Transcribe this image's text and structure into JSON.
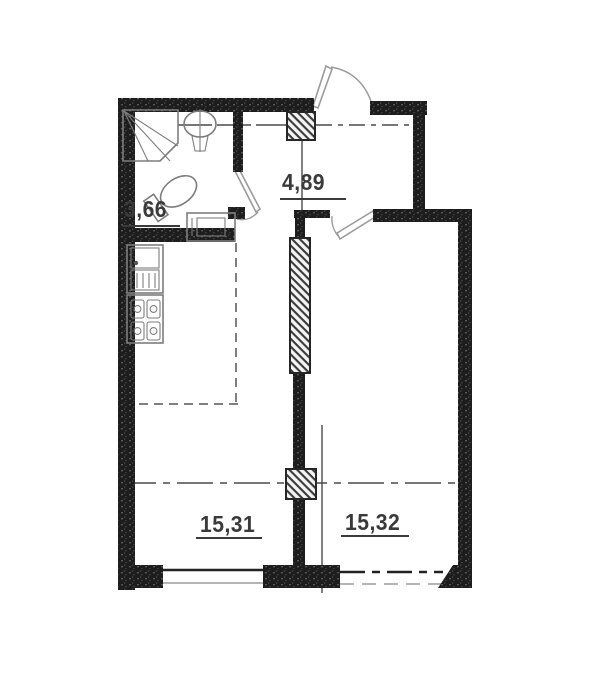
{
  "plan": {
    "title": "apartment-floor-plan",
    "rooms": {
      "bathroom": {
        "name": "bathroom",
        "area": "3,66"
      },
      "hallway": {
        "name": "hallway",
        "area": "4,89"
      },
      "living_kitchen": {
        "name": "kitchen-living-room",
        "area": "15,31"
      },
      "bedroom": {
        "name": "bedroom",
        "area": "15,32"
      }
    },
    "fixtures": [
      "shower",
      "washbasin",
      "toilet",
      "washing-machine",
      "kitchen-sink",
      "stove",
      "vent-shaft-top",
      "vent-shaft-bottom"
    ],
    "doors": [
      "entry-door",
      "bathroom-door",
      "bedroom-door"
    ],
    "windows": [
      "living-room-window",
      "bedroom-window-opening"
    ],
    "colors": {
      "wall": "#1d1d1d",
      "line": "#4a4a4a",
      "fixture": "#7d7d7d",
      "door": "#9b9b9b",
      "label": "#3a3a3a",
      "background": "#ffffff"
    }
  }
}
